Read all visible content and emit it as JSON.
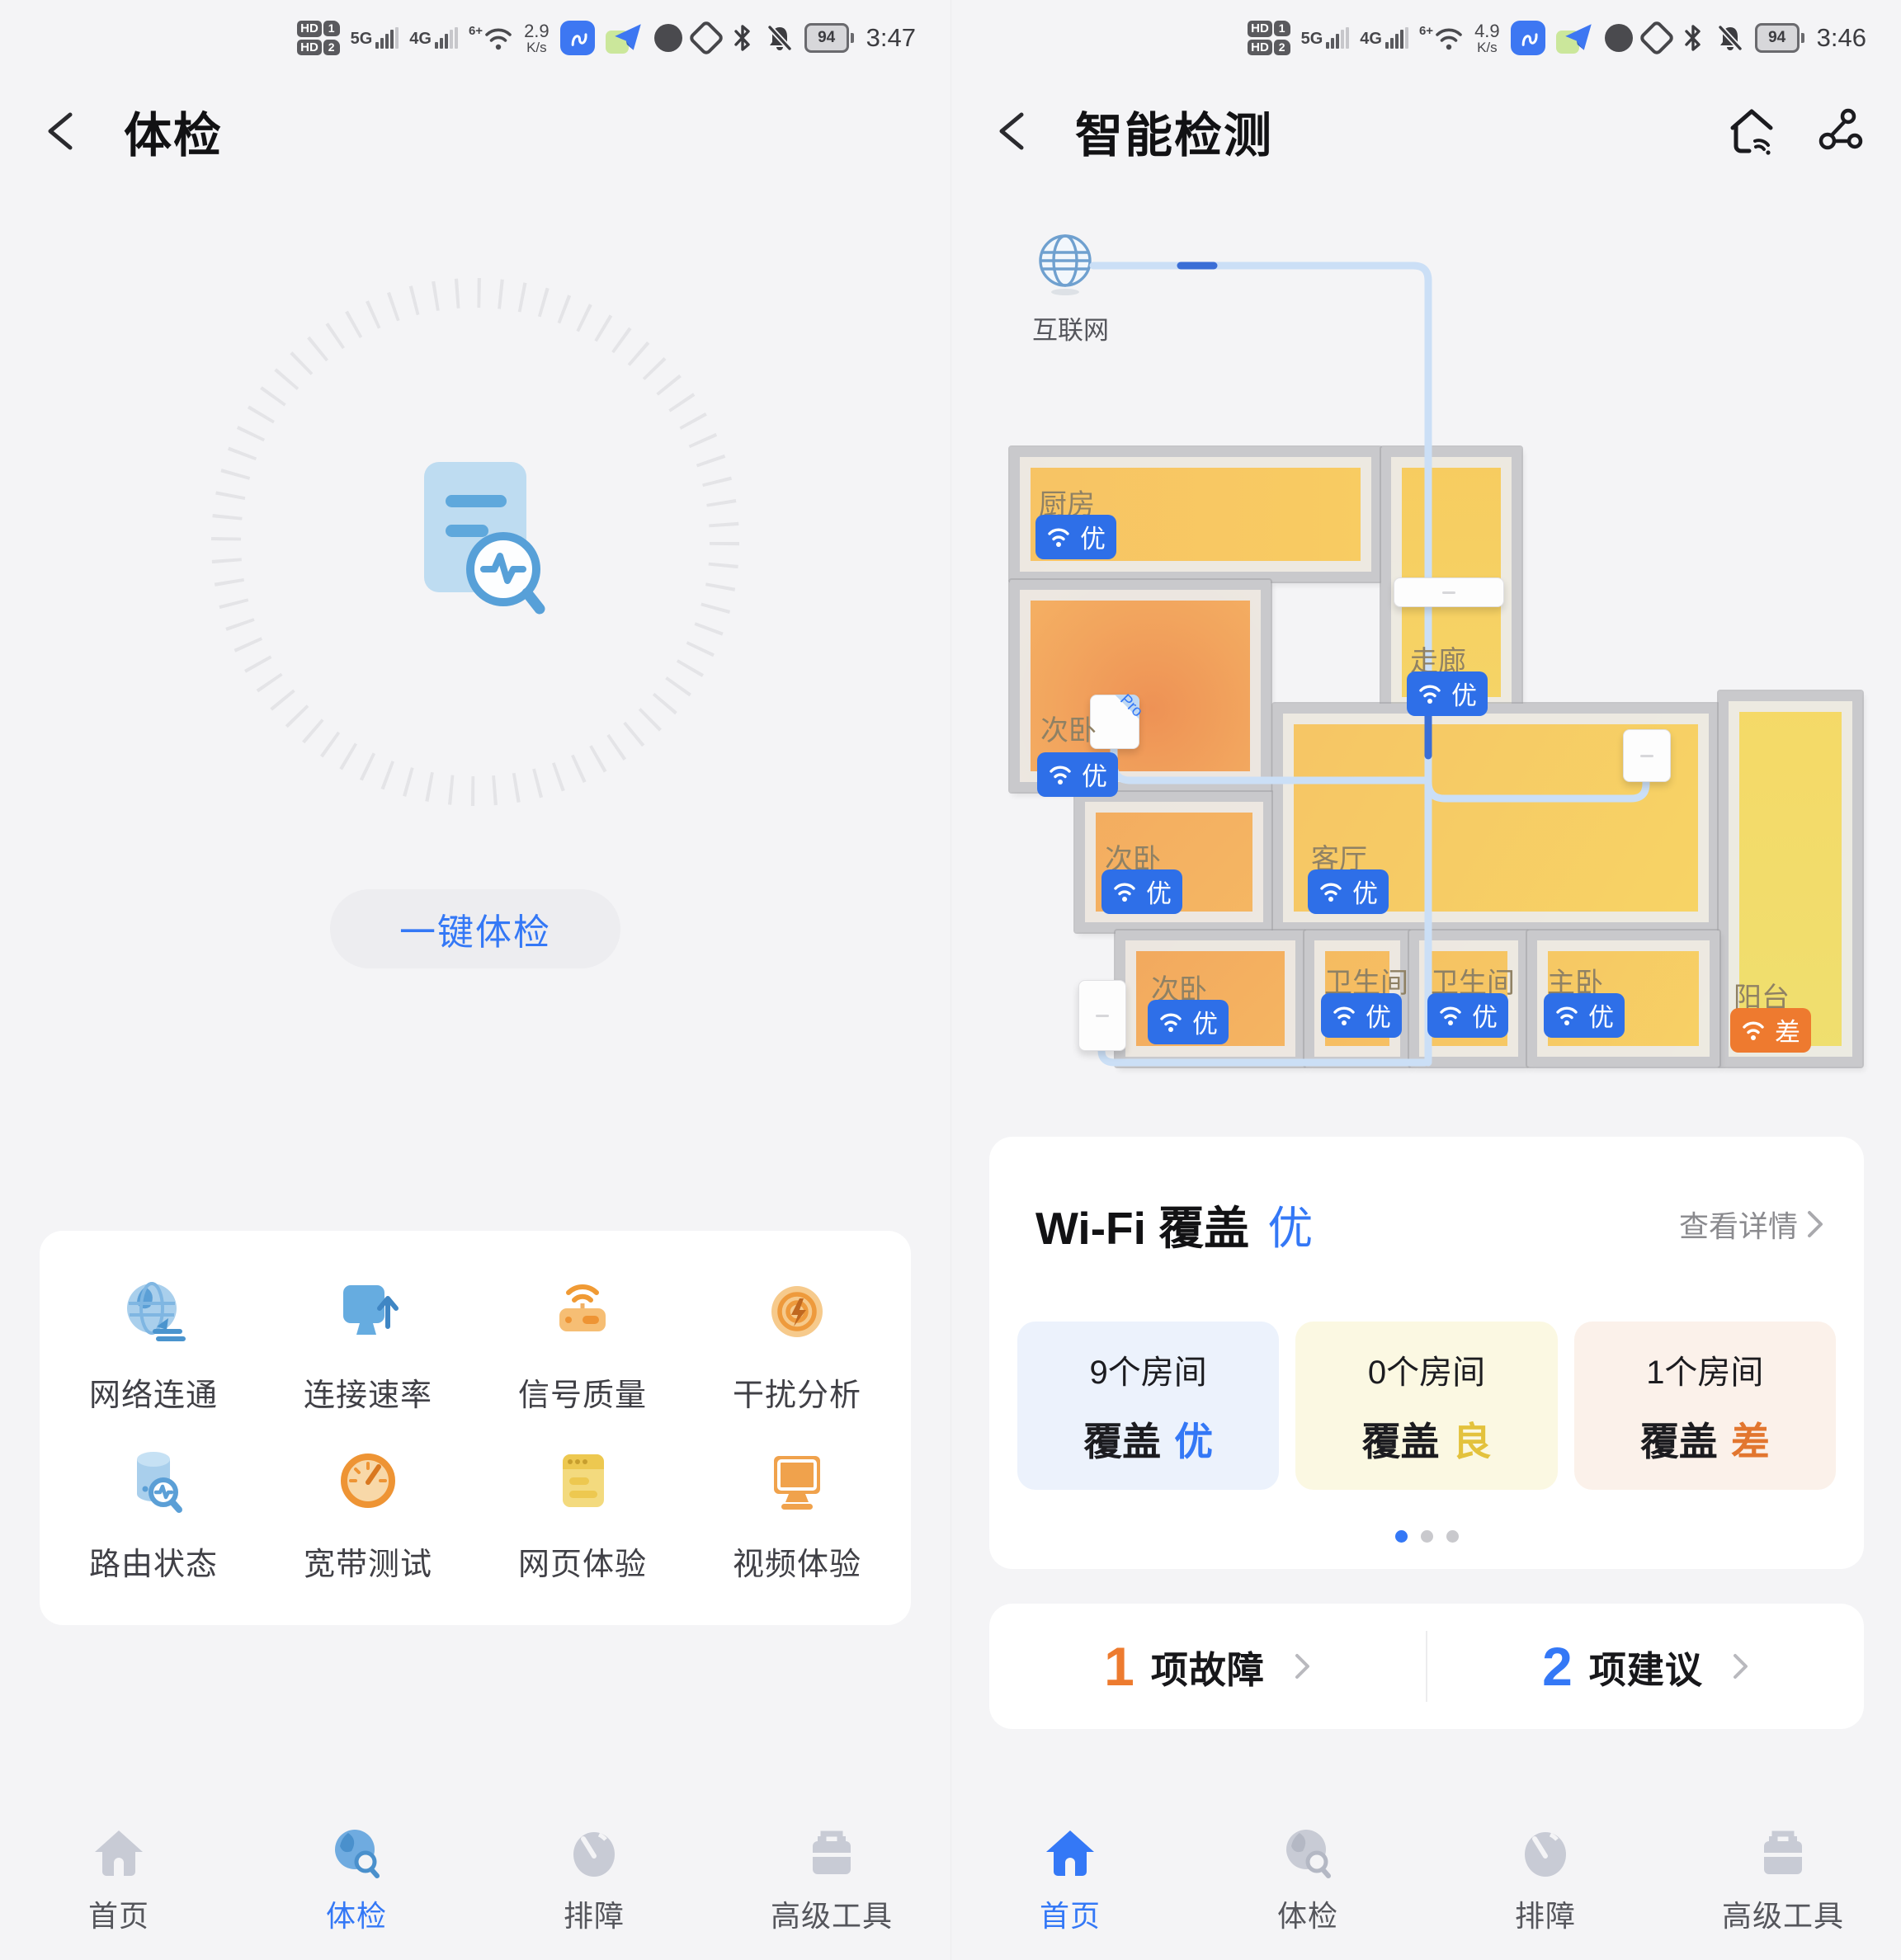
{
  "left": {
    "statusbar": {
      "hd": "HD",
      "sim1": "1",
      "sim2": "2",
      "net1": "5G",
      "net2": "4G",
      "wifi": "6+",
      "speed": "2.9",
      "unit": "K/s",
      "battery": "94",
      "time": "3:47"
    },
    "header": {
      "title": "体检"
    },
    "scan_button": "一键体检",
    "tools": [
      {
        "label": "网络连通"
      },
      {
        "label": "连接速率"
      },
      {
        "label": "信号质量"
      },
      {
        "label": "干扰分析"
      },
      {
        "label": "路由状态"
      },
      {
        "label": "宽带测试"
      },
      {
        "label": "网页体验"
      },
      {
        "label": "视频体验"
      }
    ],
    "nav": [
      {
        "label": "首页"
      },
      {
        "label": "体检"
      },
      {
        "label": "排障"
      },
      {
        "label": "高级工具"
      }
    ]
  },
  "right": {
    "statusbar": {
      "hd": "HD",
      "sim1": "1",
      "sim2": "2",
      "net1": "5G",
      "net2": "4G",
      "wifi": "6+",
      "speed": "4.9",
      "unit": "K/s",
      "battery": "94",
      "time": "3:46"
    },
    "header": {
      "title": "智能检测"
    },
    "floorplan": {
      "internet": "互联网",
      "pro_tag": "Pro",
      "rooms": [
        {
          "name": "厨房",
          "grade": "优"
        },
        {
          "name": "走廊",
          "grade": "优"
        },
        {
          "name": "次卧",
          "grade": "优"
        },
        {
          "name": "次卧",
          "grade": "优"
        },
        {
          "name": "客厅",
          "grade": "优"
        },
        {
          "name": "阳台",
          "grade": "差"
        },
        {
          "name": "次卧",
          "grade": "优"
        },
        {
          "name": "卫生间",
          "grade": "优"
        },
        {
          "name": "卫生间",
          "grade": "优"
        },
        {
          "name": "主卧",
          "grade": "优"
        }
      ]
    },
    "coverage": {
      "title": "Wi-Fi 覆盖",
      "grade": "优",
      "link": "查看详情",
      "stats": [
        {
          "count": "9个房间",
          "label": "覆盖",
          "grade": "优"
        },
        {
          "count": "0个房间",
          "label": "覆盖",
          "grade": "良"
        },
        {
          "count": "1个房间",
          "label": "覆盖",
          "grade": "差"
        }
      ]
    },
    "findings": [
      {
        "count": "1",
        "label": "项故障"
      },
      {
        "count": "2",
        "label": "项建议"
      }
    ],
    "nav": [
      {
        "label": "首页"
      },
      {
        "label": "体检"
      },
      {
        "label": "排障"
      },
      {
        "label": "高级工具"
      }
    ]
  },
  "colors": {
    "accent": "#3478F6",
    "good_badge": "#2E6FE8",
    "poor_badge": "#EE7A2F",
    "fair": "#E3C23D",
    "poor_text": "#E2762F"
  }
}
